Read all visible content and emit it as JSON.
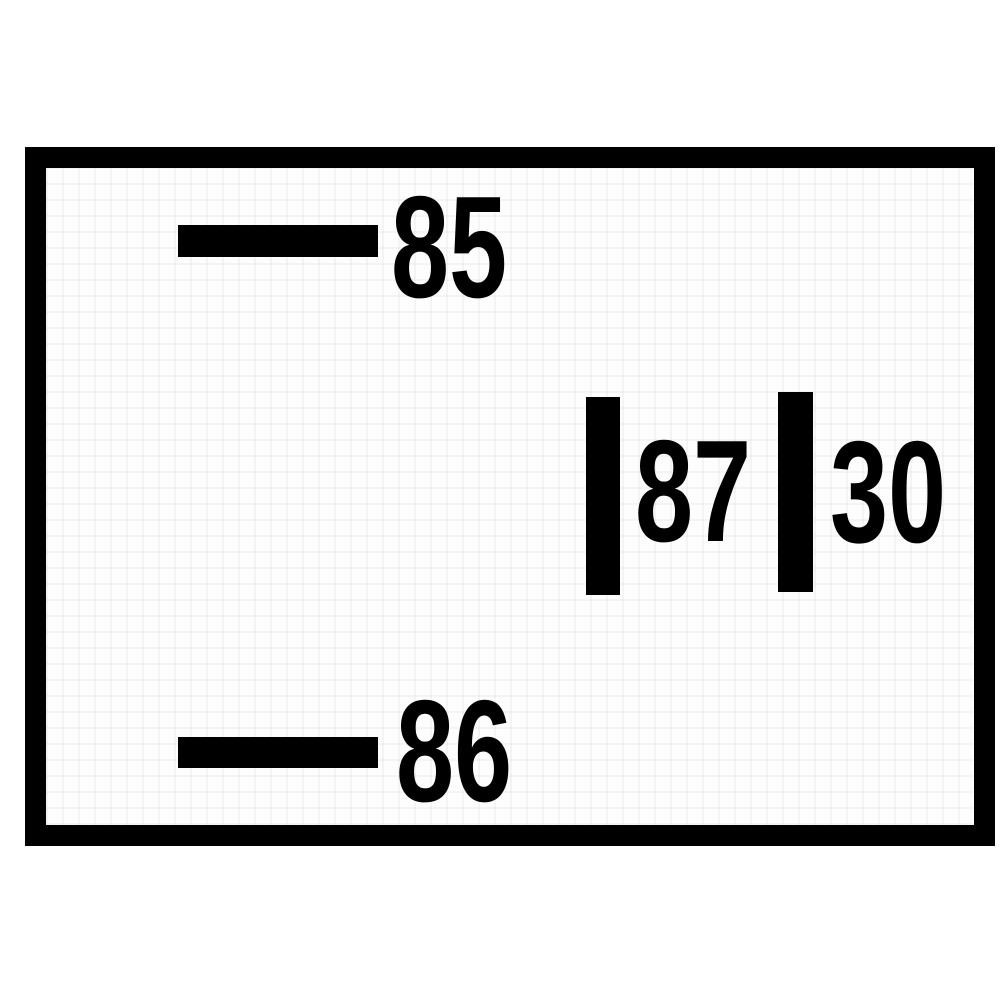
{
  "figure": {
    "type": "relay-terminal-pin-diagram"
  },
  "terminals": {
    "t85": {
      "label": "85"
    },
    "t86": {
      "label": "86"
    },
    "t87": {
      "label": "87"
    },
    "t30": {
      "label": "30"
    }
  },
  "colors": {
    "ink": "#000000",
    "paper": "#ffffff"
  }
}
